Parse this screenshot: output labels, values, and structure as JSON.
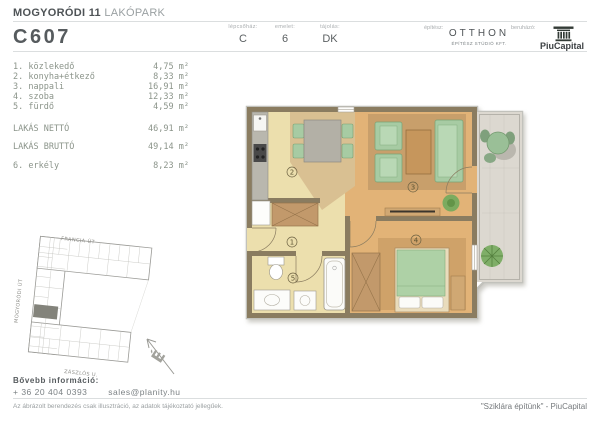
{
  "header": {
    "project_title_bold": "MOGYORÓDI 11",
    "project_title_light": "LAKÓPARK",
    "unit_code": "C607",
    "info_columns": [
      {
        "label": "lépcsőház:",
        "value": "C"
      },
      {
        "label": "emelet:",
        "value": "6"
      },
      {
        "label": "tájolás:",
        "value": "DK"
      }
    ],
    "architect": {
      "label": "építész:",
      "name": "OTTHON",
      "subtitle": "ÉPÍTÉSZ STÚDIÓ KFT."
    },
    "developer": {
      "label": "beruházó:",
      "name": "PiuCapital",
      "logo_icon": "classical-column"
    }
  },
  "room_list": {
    "items": [
      {
        "label": "1. közlekedő",
        "area": "4,75 m²"
      },
      {
        "label": "2. konyha+étkező",
        "area": "8,33 m²"
      },
      {
        "label": "3. nappali",
        "area": "16,91 m²"
      },
      {
        "label": "4. szoba",
        "area": "12,33 m²"
      },
      {
        "label": "5. fürdő",
        "area": "4,59 m²"
      }
    ],
    "net": {
      "label": "LAKÁS NETTÓ",
      "area": "46,91 m²"
    },
    "gross": {
      "label": "LAKÁS BRUTTÓ",
      "area": "49,14 m²"
    },
    "balcony": {
      "label": "6. erkély",
      "area": "8,23 m²"
    }
  },
  "floorplan": {
    "room_labels": [
      "1",
      "2",
      "3",
      "4",
      "5"
    ],
    "colors": {
      "wall": "#8a7c60",
      "floor_light": "#ecdfad",
      "floor_wood": "#e2b377",
      "dining_zone": "#d9c092",
      "rug": "#c89f6b",
      "furniture_green": "#a7cba3",
      "furniture_wood": "#c2996b",
      "balcony_floor": "#dcd8d0"
    }
  },
  "siteplan": {
    "street_top": "FRANCIA ÚT",
    "street_left": "MOGYORÓDI ÚT",
    "street_bottom": "ZÁSZLÓS U.",
    "north_letter": "É"
  },
  "footer": {
    "info_label": "Bővebb információ:",
    "phone": "+ 36 20 404 0393",
    "email": "sales@planity.hu",
    "disclaimer": "Az ábrázolt berendezés csak illusztráció, az adatok tájékoztató jellegűek.",
    "slogan": "\"Sziklára építünk\" - PiuCapital"
  }
}
